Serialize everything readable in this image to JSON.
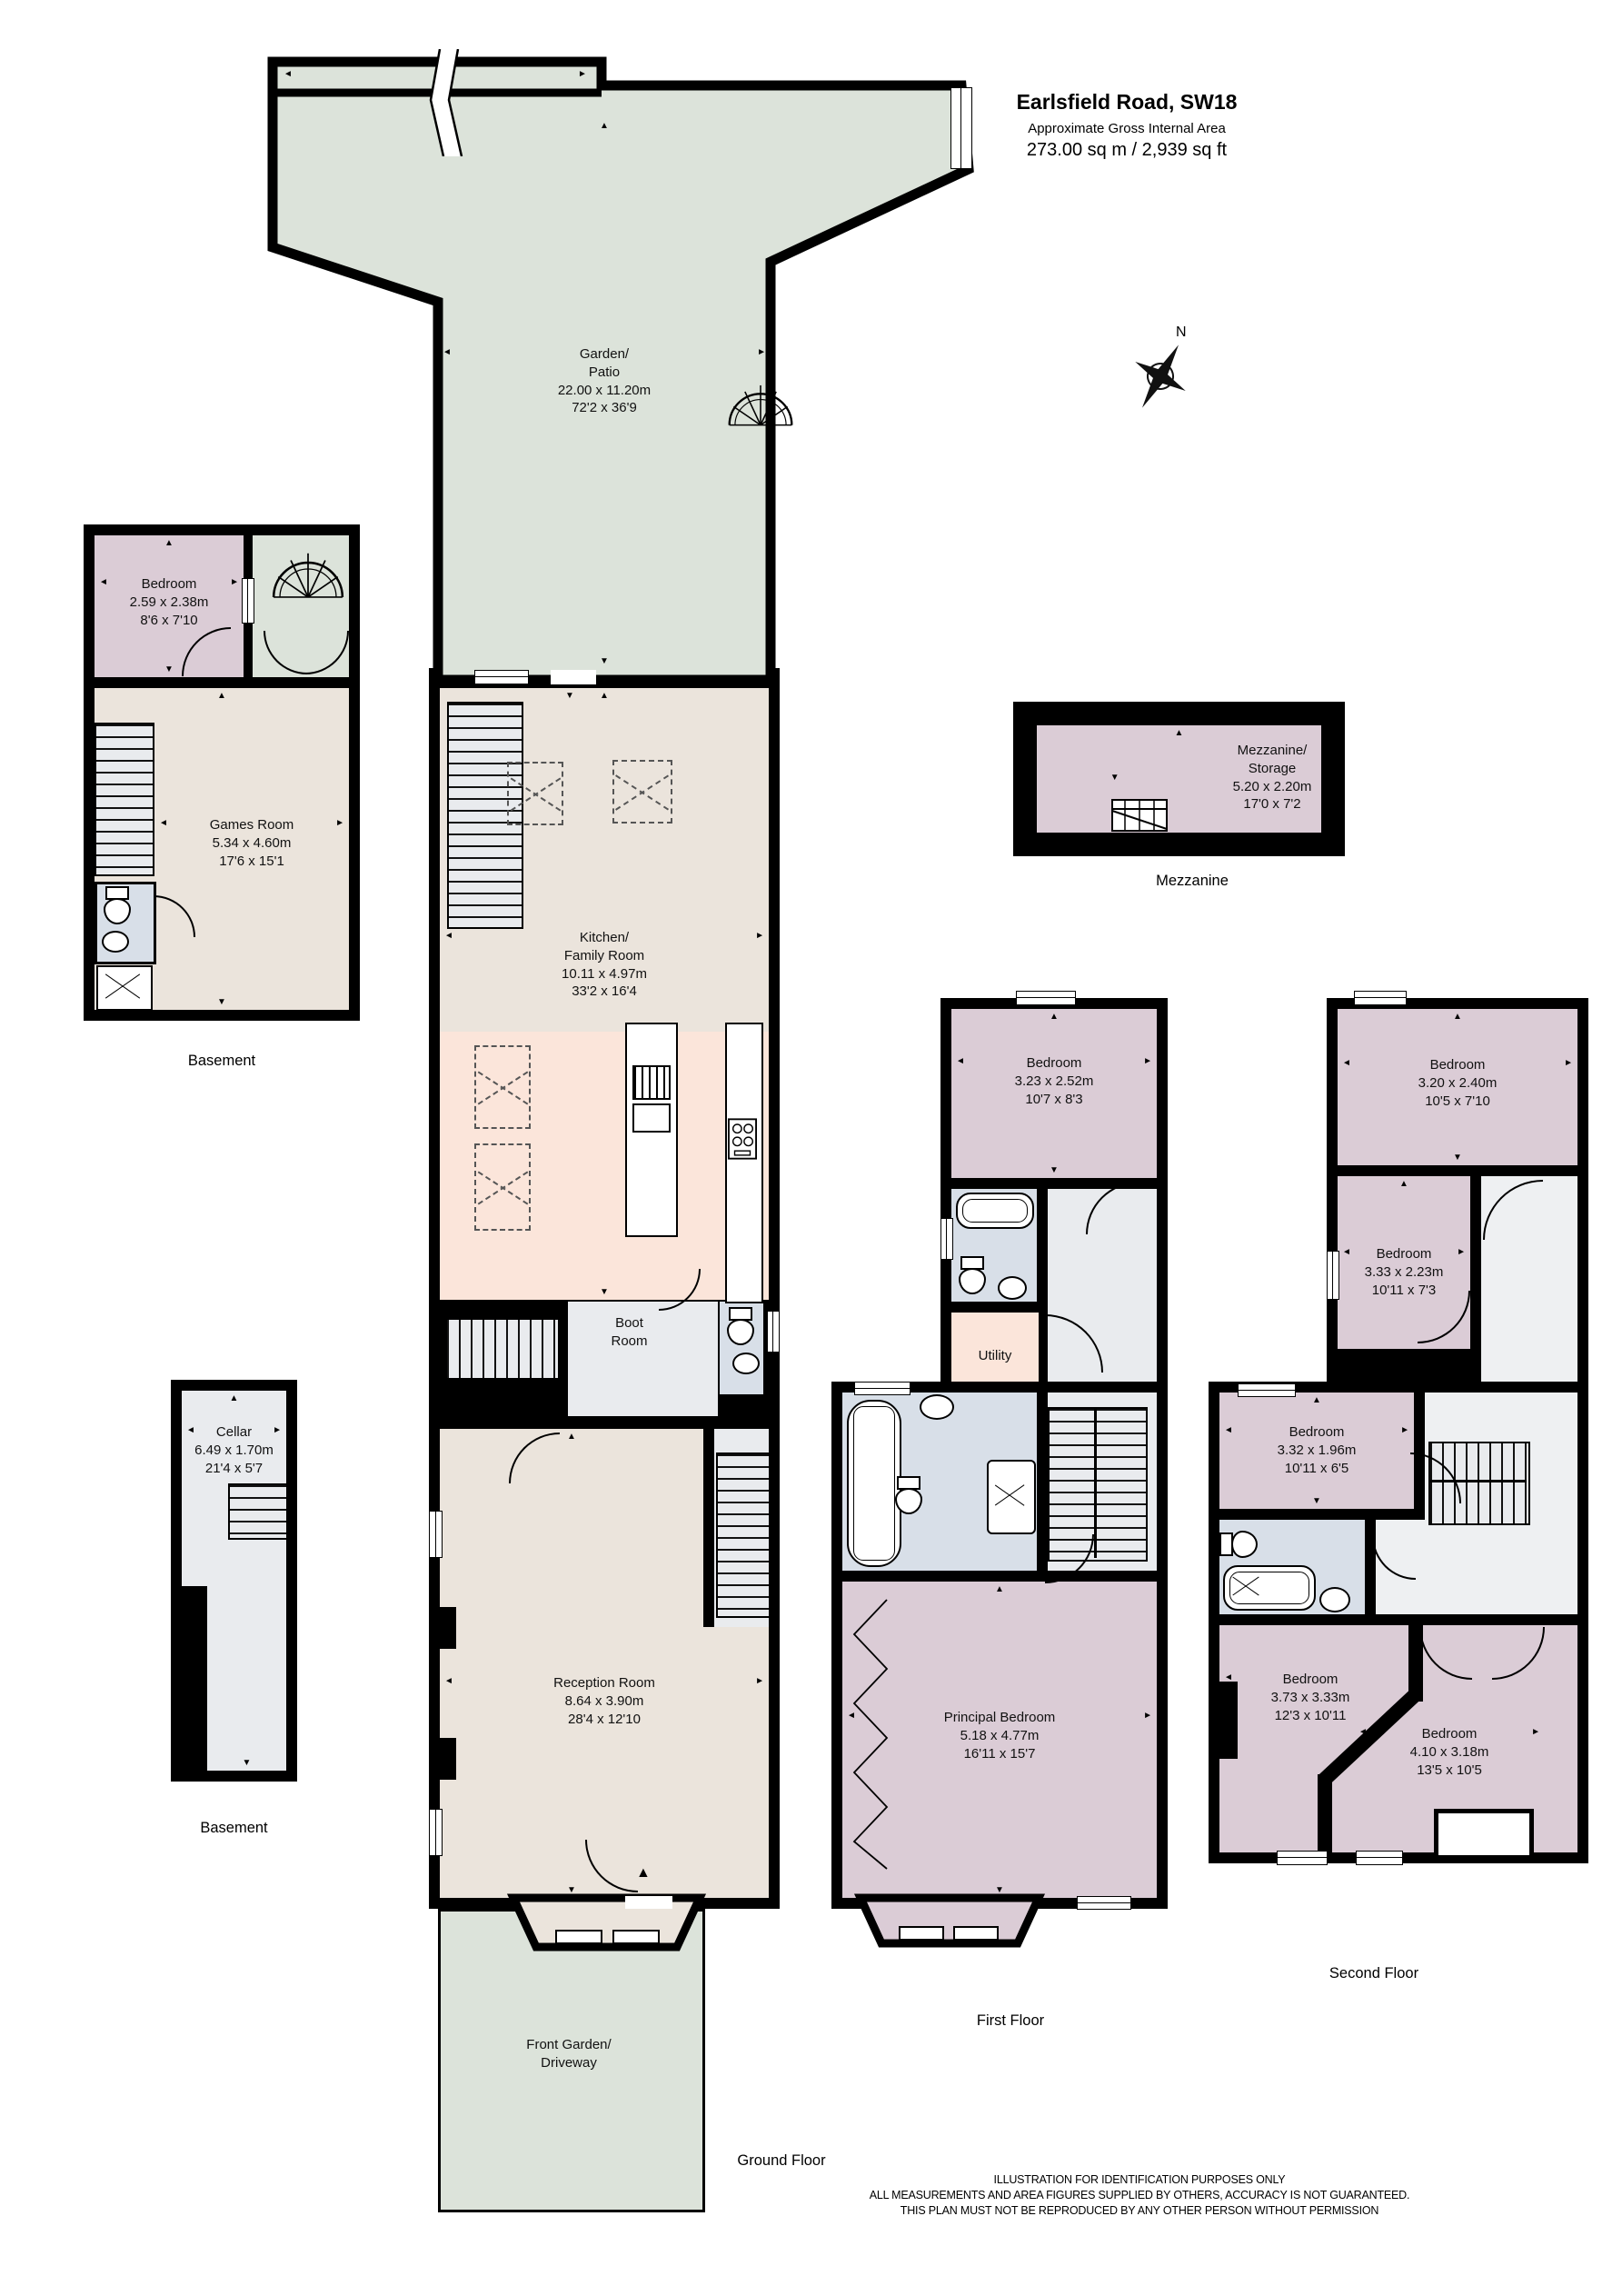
{
  "title": {
    "address": "Earlsfield Road, SW18",
    "subtitle": "Approximate Gross Internal Area",
    "area": "273.00 sq m / 2,939 sq ft"
  },
  "compass": {
    "north": "N"
  },
  "colors": {
    "garden_green": "#dce3da",
    "bedroom_mauve": "#dbccd6",
    "beige": "#ebe4dc",
    "kitchen_pink": "#fbe5da",
    "bath_blue": "#d8dfe8",
    "hall_grey": "#e9ebee",
    "wall_black": "#000000"
  },
  "floors": {
    "basement1": {
      "label": "Basement"
    },
    "basement2": {
      "label": "Basement"
    },
    "ground": {
      "label": "Ground Floor"
    },
    "first": {
      "label": "First Floor"
    },
    "second": {
      "label": "Second Floor"
    },
    "mezzanine": {
      "label": "Mezzanine"
    }
  },
  "rooms": {
    "garden": {
      "lines": [
        "Garden/",
        "Patio"
      ],
      "metric": "22.00 x 11.20m",
      "imperial": "72'2 x 36'9"
    },
    "basement_bedroom": {
      "name": "Bedroom",
      "metric": "2.59 x 2.38m",
      "imperial": "8'6 x 7'10"
    },
    "games_room": {
      "name": "Games Room",
      "metric": "5.34 x 4.60m",
      "imperial": "17'6 x 15'1"
    },
    "cellar": {
      "name": "Cellar",
      "metric": "6.49 x 1.70m",
      "imperial": "21'4 x 5'7"
    },
    "kitchen": {
      "lines": [
        "Kitchen/",
        "Family Room"
      ],
      "metric": "10.11 x 4.97m",
      "imperial": "33'2 x 16'4"
    },
    "boot_room": {
      "lines": [
        "Boot",
        "Room"
      ]
    },
    "reception": {
      "name": "Reception Room",
      "metric": "8.64 x 3.90m",
      "imperial": "28'4 x 12'10"
    },
    "front_garden": {
      "lines": [
        "Front Garden/",
        "Driveway"
      ]
    },
    "ff_bedroom": {
      "name": "Bedroom",
      "metric": "3.23 x 2.52m",
      "imperial": "10'7 x 8'3"
    },
    "utility": {
      "name": "Utility"
    },
    "principal": {
      "name": "Principal Bedroom",
      "metric": "5.18 x 4.77m",
      "imperial": "16'11 x 15'7"
    },
    "mezzanine": {
      "lines": [
        "Mezzanine/",
        "Storage"
      ],
      "metric": "5.20 x 2.20m",
      "imperial": "17'0 x 7'2"
    },
    "sf_bedroom1": {
      "name": "Bedroom",
      "metric": "3.20 x 2.40m",
      "imperial": "10'5 x 7'10"
    },
    "sf_bedroom2": {
      "name": "Bedroom",
      "metric": "3.33 x 2.23m",
      "imperial": "10'11 x 7'3"
    },
    "sf_bedroom3": {
      "name": "Bedroom",
      "metric": "3.32 x 1.96m",
      "imperial": "10'11 x 6'5"
    },
    "sf_bedroom4": {
      "name": "Bedroom",
      "metric": "3.73 x 3.33m",
      "imperial": "12'3 x 10'11"
    },
    "sf_bedroom5": {
      "name": "Bedroom",
      "metric": "4.10 x 3.18m",
      "imperial": "13'5 x 10'5"
    }
  },
  "footer": {
    "line1": "ILLUSTRATION FOR IDENTIFICATION PURPOSES ONLY",
    "line2": "ALL MEASUREMENTS AND AREA FIGURES SUPPLIED BY OTHERS, ACCURACY IS NOT GUARANTEED.",
    "line3": "THIS PLAN MUST NOT BE REPRODUCED BY ANY OTHER PERSON WITHOUT PERMISSION"
  }
}
